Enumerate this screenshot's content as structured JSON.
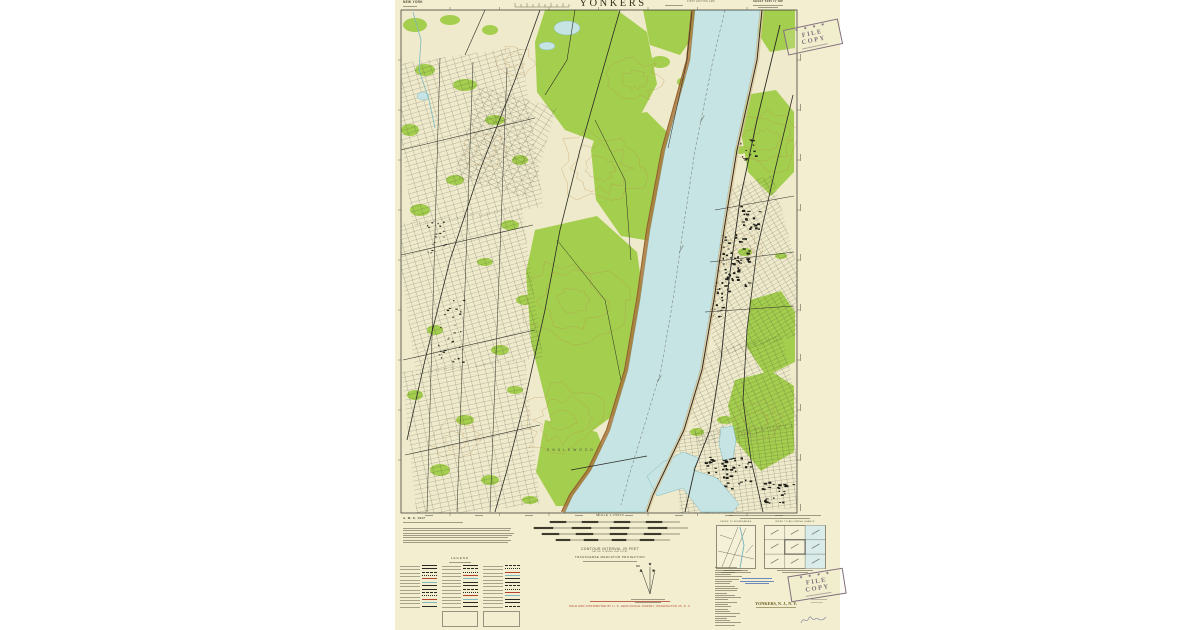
{
  "page": {
    "background": "#ffffff"
  },
  "sheet": {
    "paper_color": "#f2eecf",
    "map_bg": "#efeacb",
    "colors": {
      "vegetation_green": "#9ccb40",
      "water_blue": "#c6e4e3",
      "water_edge": "#7fb8c0",
      "contour_brown": "#b98a4e",
      "palisades_brown": "#a87840",
      "ink_black": "#2a2a25",
      "margin_ink": "#4f4a38",
      "red_overprint": "#b5442e",
      "stamp_purple": "#82707e",
      "stamp_blue": "#4a72b8"
    }
  },
  "header": {
    "state_label": "NEW YORK",
    "title": "YONKERS",
    "edition_note": "FIRST EDITION AMS",
    "sheet_note": "SHEET 6265 IV NW"
  },
  "stamps": {
    "stars": "✱ ✱ ✱ ✱",
    "file_copy": "FILE COPY"
  },
  "footer": {
    "credit_heading": "A. M. S. 1947",
    "scale_label": "SCALE 1:25000",
    "contour_note": "CONTOUR INTERVAL 20 FEET",
    "contour_sub": "DATUM IS MEAN SEA LEVEL",
    "projection_note": "TRANSVERSE MERCATOR PROJECTION",
    "legend_title": "LEGEND",
    "index_boundaries_caption": "INDEX TO BOUNDARIES",
    "index_adjoining_caption": "INDEX TO ADJOINING SHEETS",
    "distribution_note": "SOLD AND DISTRIBUTED BY U. S. GEOLOGICAL SURVEY, WASHINGTON 25, D. C.",
    "map_name": "YONKERS, N. J., N. Y."
  },
  "map": {
    "labels": [
      {
        "t": "E N G L E W O O D",
        "x": 152,
        "y": 451,
        "s": 3.4,
        "c": "#4a4a40"
      }
    ],
    "greens_poly": [
      "150,10 222,10 252,32 262,84 242,122 202,142 170,130 142,92 140,42",
      "205,120 252,112 282,142 287,202 262,242 226,236 201,200 196,150",
      "140,230 202,216 242,252 252,322 236,402 196,432 156,422 136,342 131,272",
      "150,420 202,432 217,472 197,506 161,506 141,472",
      "350,95 381,90 399,112 399,172 376,196 353,172 346,132",
      "355,300 386,291 400,312 400,362 371,376 351,346",
      "340,380 376,371 399,386 399,452 366,471 341,441 333,406",
      "248,10 300,10 303,30 285,55 255,45",
      "368,10 400,10 400,48 375,52 362,32"
    ],
    "greens_ell": [
      [
        20,
        25,
        12,
        7
      ],
      [
        55,
        20,
        10,
        5
      ],
      [
        95,
        30,
        8,
        5
      ],
      [
        30,
        70,
        10,
        6
      ],
      [
        70,
        85,
        12,
        6
      ],
      [
        15,
        130,
        9,
        6
      ],
      [
        100,
        120,
        10,
        5
      ],
      [
        125,
        160,
        8,
        5
      ],
      [
        60,
        180,
        9,
        5
      ],
      [
        25,
        210,
        10,
        6
      ],
      [
        115,
        225,
        9,
        5
      ],
      [
        90,
        262,
        8,
        4
      ],
      [
        130,
        300,
        9,
        5
      ],
      [
        40,
        330,
        8,
        5
      ],
      [
        105,
        350,
        9,
        5
      ],
      [
        20,
        395,
        8,
        5
      ],
      [
        70,
        420,
        9,
        5
      ],
      [
        120,
        390,
        8,
        4
      ],
      [
        45,
        470,
        10,
        6
      ],
      [
        95,
        480,
        9,
        5
      ],
      [
        135,
        500,
        8,
        4
      ],
      [
        265,
        62,
        10,
        6
      ],
      [
        290,
        82,
        8,
        5
      ],
      [
        345,
        150,
        7,
        4
      ],
      [
        390,
        152,
        6,
        4
      ],
      [
        350,
        252,
        7,
        4
      ],
      [
        386,
        256,
        6,
        3
      ],
      [
        330,
        420,
        8,
        4
      ],
      [
        302,
        432,
        7,
        4
      ],
      [
        248,
        60,
        9,
        5
      ],
      [
        232,
        92,
        8,
        5
      ]
    ],
    "river_west": [
      [
        300,
        10
      ],
      [
        295,
        60
      ],
      [
        270,
        150
      ],
      [
        255,
        230
      ],
      [
        245,
        300
      ],
      [
        233,
        370
      ],
      [
        215,
        430
      ],
      [
        196,
        470
      ],
      [
        178,
        495
      ],
      [
        170,
        512
      ]
    ],
    "river_east": [
      [
        365,
        10
      ],
      [
        360,
        60
      ],
      [
        340,
        150
      ],
      [
        327,
        230
      ],
      [
        317,
        300
      ],
      [
        305,
        370
      ],
      [
        287,
        430
      ],
      [
        268,
        470
      ],
      [
        256,
        495
      ],
      [
        250,
        512
      ]
    ],
    "inlet": "252,476 268,462 288,452 304,458 298,470 322,478 344,504 338,512 306,512 288,488 262,496",
    "reservoir": "326,428 338,426 341,440 338,458 328,460 324,444",
    "ponds": [
      [
        172,
        28,
        13,
        7
      ],
      [
        152,
        46,
        8,
        4
      ],
      [
        28,
        96,
        6,
        4
      ]
    ],
    "creek": "18,12 26,40 24,70 34,100 40,128",
    "grids": [
      {
        "x": 6,
        "y": 55,
        "w": 132,
        "h": 162,
        "rot": -8,
        "sx": 8,
        "sy": 4.5
      },
      {
        "x": 10,
        "y": 215,
        "w": 128,
        "h": 152,
        "rot": -8,
        "sx": 7.5,
        "sy": 4.2
      },
      {
        "x": 14,
        "y": 365,
        "w": 124,
        "h": 146,
        "rot": -6,
        "sx": 8,
        "sy": 4.5
      },
      {
        "x": 70,
        "y": 95,
        "w": 80,
        "h": 95,
        "rot": 16,
        "sx": 9,
        "sy": 5
      },
      {
        "x": 300,
        "y": 185,
        "w": 100,
        "h": 162,
        "rot": -15,
        "sx": 6.5,
        "sy": 3.8
      },
      {
        "x": 292,
        "y": 345,
        "w": 106,
        "h": 92,
        "rot": -12,
        "sx": 7,
        "sy": 4
      },
      {
        "x": 282,
        "y": 428,
        "w": 120,
        "h": 84,
        "rot": -4,
        "sx": 6,
        "sy": 3.6
      }
    ],
    "blocks": [
      {
        "cx": 337,
        "cy": 262,
        "w": 34,
        "h": 58,
        "n": 70,
        "s": 2.2
      },
      {
        "cx": 318,
        "cy": 300,
        "w": 22,
        "h": 34,
        "n": 28,
        "s": 2
      },
      {
        "cx": 354,
        "cy": 218,
        "w": 20,
        "h": 26,
        "n": 22,
        "s": 2.2
      },
      {
        "cx": 332,
        "cy": 472,
        "w": 48,
        "h": 32,
        "n": 55,
        "s": 2.4
      },
      {
        "cx": 382,
        "cy": 492,
        "w": 32,
        "h": 22,
        "n": 28,
        "s": 2.2
      },
      {
        "cx": 56,
        "cy": 330,
        "w": 26,
        "h": 64,
        "n": 30,
        "s": 1.6
      },
      {
        "cx": 40,
        "cy": 240,
        "w": 20,
        "h": 40,
        "n": 18,
        "s": 1.5
      },
      {
        "cx": 352,
        "cy": 150,
        "w": 16,
        "h": 22,
        "n": 14,
        "s": 1.8
      }
    ],
    "roads": [
      {
        "p": "145,10 120,80 85,170 55,260 30,360 12,440",
        "w": 0.8
      },
      {
        "p": "225,10 205,80 185,150 165,230 150,310 130,400 112,470 100,512",
        "w": 0.8
      },
      {
        "p": "6,150 140,118",
        "w": 0.6
      },
      {
        "p": "6,255 138,225",
        "w": 0.6
      },
      {
        "p": "8,360 140,330",
        "w": 0.6
      },
      {
        "p": "10,455 145,425",
        "w": 0.6
      },
      {
        "p": "45,58 32,512",
        "w": 0.5
      },
      {
        "p": "78,62 62,512",
        "w": 0.5
      },
      {
        "p": "112,68 95,512",
        "w": 0.5
      },
      {
        "p": "385,25 362,120 345,200 334,280 326,360 315,430 300,468 290,512",
        "w": 0.9
      },
      {
        "p": "398,95 380,170 362,250 352,330 348,400 356,460 368,512",
        "w": 0.8
      },
      {
        "p": "320,210 399,196",
        "w": 0.5
      },
      {
        "p": "315,262 399,252",
        "w": 0.5
      },
      {
        "p": "310,312 399,306",
        "w": 0.5
      },
      {
        "p": "200,120 230,180 236,260",
        "w": 0.5
      },
      {
        "p": "162,240 210,300 226,380",
        "w": 0.5
      },
      {
        "p": "176,470 252,456",
        "w": 0.7
      },
      {
        "p": "90,10 70,55",
        "w": 0.6
      },
      {
        "p": "180,10 172,60 150,95",
        "w": 0.6
      }
    ],
    "rails": [
      {
        "p": "367,10 362,60 342,150 329,230 319,300 307,370 289,430 270,470 258,495 252,512",
        "w": 0.9
      },
      {
        "p": "297,12 292,60 273,148",
        "w": 0.5
      }
    ],
    "channel": "330,10 318,60 300,150 288,230 278,300 266,370 248,430 234,476 226,505",
    "contours": [
      {
        "cx": 205,
        "cy": 168,
        "r": 14,
        "n": 3
      },
      {
        "cx": 178,
        "cy": 300,
        "r": 16,
        "n": 3
      },
      {
        "cx": 168,
        "cy": 420,
        "r": 13,
        "n": 3
      },
      {
        "cx": 372,
        "cy": 140,
        "r": 12,
        "n": 3
      },
      {
        "cx": 362,
        "cy": 420,
        "r": 11,
        "n": 2
      },
      {
        "cx": 348,
        "cy": 252,
        "r": 10,
        "n": 2
      },
      {
        "cx": 240,
        "cy": 80,
        "r": 12,
        "n": 2
      },
      {
        "cx": 90,
        "cy": 150,
        "r": 10,
        "n": 2
      },
      {
        "cx": 60,
        "cy": 440,
        "r": 11,
        "n": 2
      },
      {
        "cx": 120,
        "cy": 60,
        "r": 9,
        "n": 2
      }
    ]
  }
}
